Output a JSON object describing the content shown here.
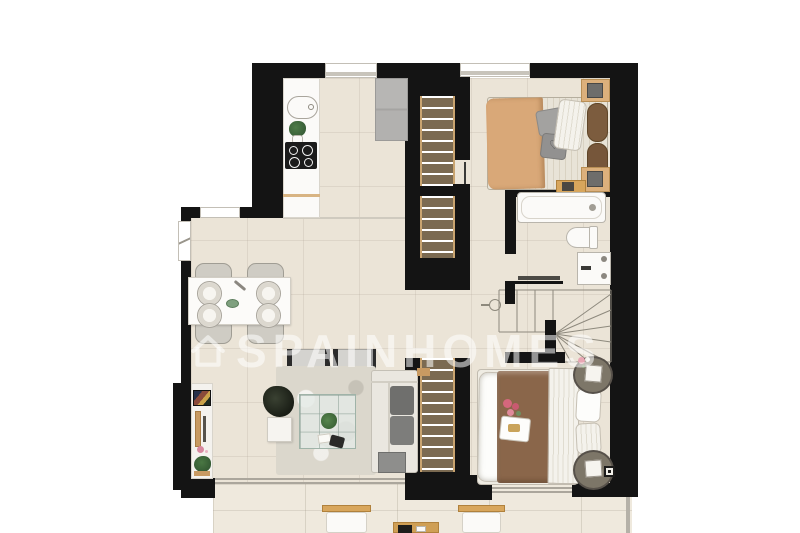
{
  "watermark": {
    "brand": "SPAINHOMES",
    "logo": "house-icon"
  },
  "colors": {
    "wall": "#141414",
    "floor": "#ebe4d7",
    "terrace": "#efe9dd",
    "tread": "#7b6a51",
    "stringer": "#c9a470",
    "wood": "#d8a65c",
    "bed1_blanket": "#d9a878",
    "bed2_blanket": "#8a664a",
    "fridge": "#b7b6b4",
    "rug": "#dbd7cc",
    "sofa_cushion": "#6f6f6d",
    "plant": "#45703f",
    "wm": "rgba(255,255,255,0.55)"
  },
  "plan": {
    "type": "floor-plan",
    "rooms": [
      {
        "name": "kitchen",
        "furniture": [
          "counter",
          "sink",
          "plant-pot",
          "cooktop",
          "tall-unit"
        ]
      },
      {
        "name": "bedroom-1",
        "furniture": [
          "double-bed",
          "pillows",
          "nightstand-left",
          "nightstand-right",
          "lamps",
          "window"
        ]
      },
      {
        "name": "bathroom",
        "furniture": [
          "bathtub",
          "toilet",
          "washbasin",
          "wall-shelf"
        ]
      },
      {
        "name": "bedroom-2",
        "furniture": [
          "double-bed",
          "pillows",
          "round-nightstand-top",
          "round-nightstand-bottom",
          "lamps",
          "flowers"
        ]
      },
      {
        "name": "living-dining-room",
        "furniture": [
          "dining-table",
          "dining-chairs",
          "dinner-plates",
          "tv-unit",
          "armchairs",
          "corner-sofa",
          "coffee-table",
          "rug",
          "plant",
          "side-table"
        ]
      },
      {
        "name": "staircase",
        "furniture": [
          "upper-flight",
          "lower-flight",
          "winder-stair"
        ]
      },
      {
        "name": "terrace",
        "furniture": [
          "lounge-chair-left",
          "lounge-chair-right",
          "low-table"
        ]
      }
    ]
  }
}
